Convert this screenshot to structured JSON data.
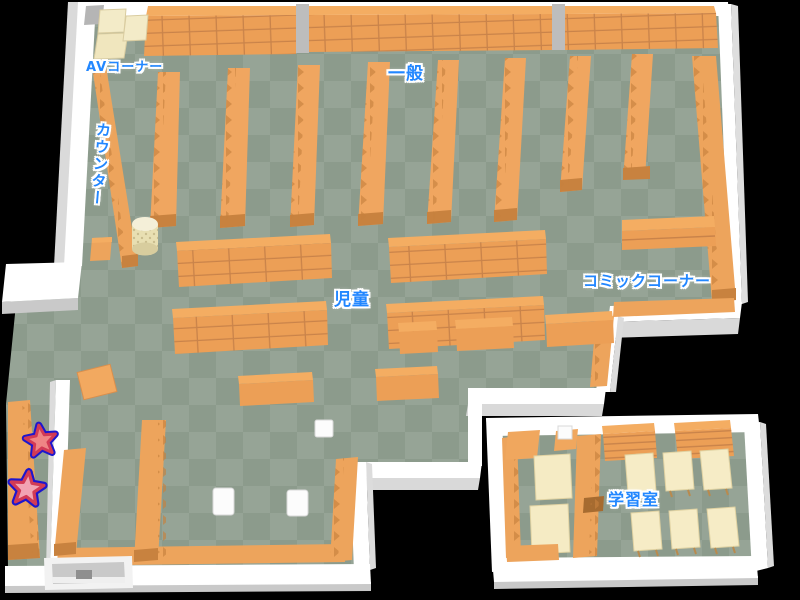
{
  "map": {
    "labels": {
      "av_corner": "AVコーナー",
      "general": "一般",
      "counter": "カウンター",
      "children": "児童",
      "comic_corner": "コミックコーナー",
      "study_room": "学習室"
    },
    "markers": [
      {
        "icon": "star-icon"
      },
      {
        "icon": "star-icon"
      }
    ],
    "colors": {
      "background": "#000000",
      "floor_dark": "#8C9B8C",
      "floor_light": "#96A496",
      "wall": "#FFFFFF",
      "wall_shade": "#D9D9D9",
      "shelf_top": "#F4AD62",
      "shelf_front": "#EC9F56",
      "shelf_shadow": "#C8823F",
      "table_cream": "#F5EBC4",
      "pillar_gray": "#BDBDBD",
      "label_blue": "#2287FF",
      "star_fill": "#EF8585",
      "star_inner_ring": "#D23A55",
      "star_outer_ring": "#1D16CE"
    }
  }
}
